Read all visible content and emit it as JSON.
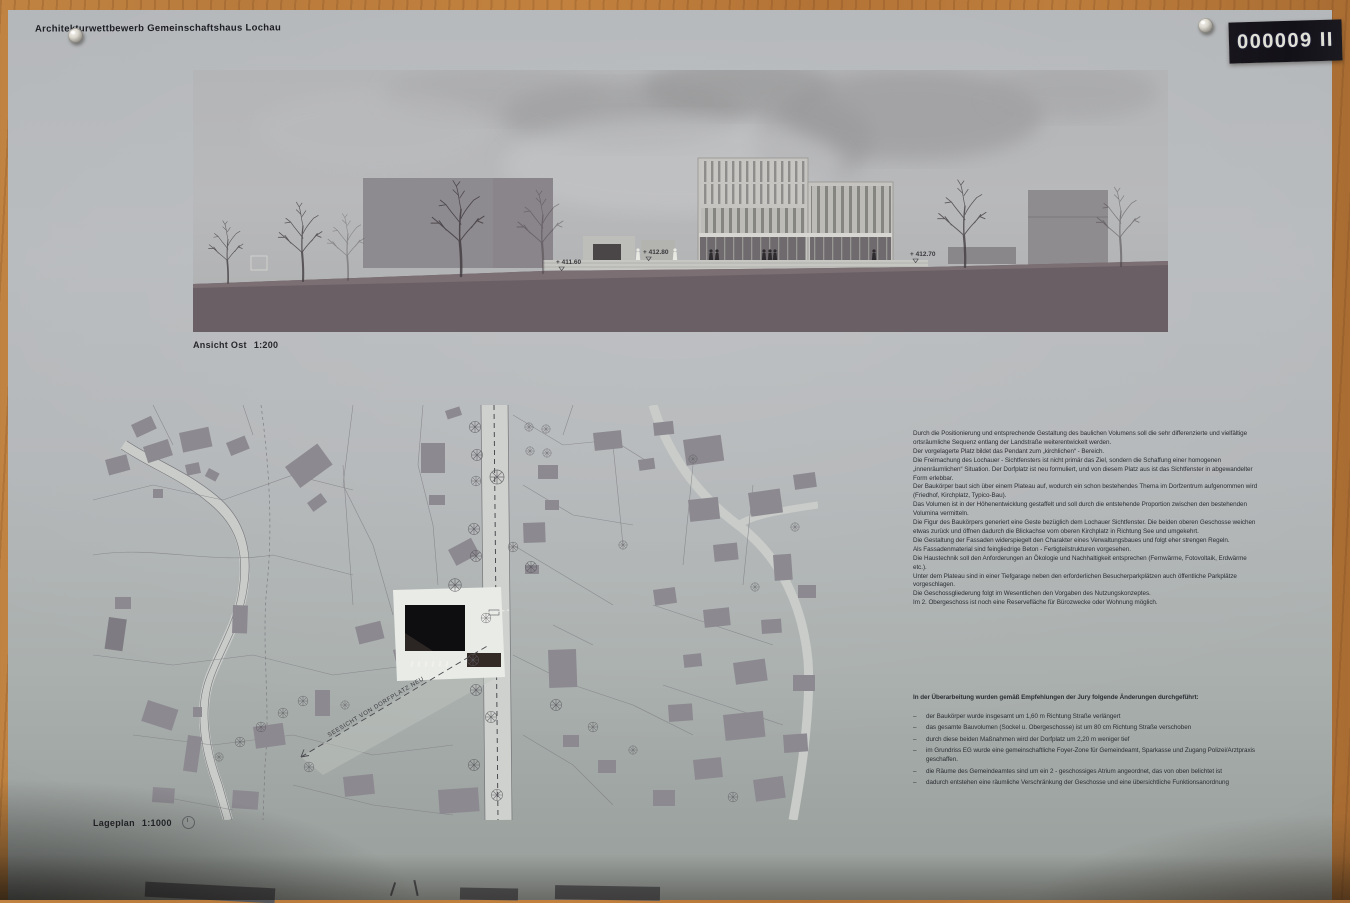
{
  "board": {
    "label": "000009 II"
  },
  "poster": {
    "title": "Architekturwettbewerb Gemeinschaftshaus Lochau",
    "elevation": {
      "caption": "Ansicht Ost",
      "scale": "1:200",
      "level_markers": [
        "+ 411.60",
        "+ 412.80",
        "+ 412.70"
      ]
    },
    "siteplan": {
      "caption": "Lageplan",
      "scale": "1:1000",
      "sightline_label": "SEESICHT VON DORFPLATZ NEU"
    },
    "description": {
      "paragraphs": [
        "Durch die Positionierung und entsprechende Gestaltung des baulichen Volumens soll die sehr differenzierte und vielfältige ortsräumliche Sequenz entlang der Landstraße weiterentwickelt werden.",
        "Der vorgelagerte Platz bildet das Pendant zum „kirchlichen“ - Bereich.",
        "Die Freimachung des Lochauer - Sichtfensters ist nicht primär das Ziel, sondern die Schaffung einer homogenen „innenräumlichen“ Situation. Der Dorfplatz ist neu formuliert, und von diesem Platz aus ist das Sichtfenster in abgewandelter Form erlebbar.",
        "Der Baukörper baut sich über einem Plateau auf, wodurch ein schon bestehendes Thema im Dorfzentrum aufgenommen wird (Friedhof, Kirchplatz, Typico-Bau).",
        "Das Volumen ist in der Höhenentwicklung gestaffelt und soll durch die entstehende Proportion zwischen den bestehenden Volumina vermitteln.",
        "Die Figur des Baukörpers generiert eine Geste bezüglich dem Lochauer Sichtfenster. Die beiden oberen Geschosse weichen etwas zurück und öffnen dadurch die Blickachse vom oberen Kirchplatz in Richtung See und umgekehrt.",
        "Die Gestaltung der Fassaden widerspiegelt den Charakter eines Verwaltungsbaues und folgt eher strengen Regeln.",
        "Als Fassadenmaterial sind feingliedrige Beton - Fertigteilstrukturen vorgesehen.",
        "Die Haustechnik soll den Anforderungen an Ökologie und Nachhaltigkeit entsprechen (Fernwärme, Fotovoltaik, Erdwärme etc.).",
        "Unter dem Plateau sind in einer Tiefgarage neben den erforderlichen Besucherparkplätzen auch öffentliche Parkplätze vorgeschlagen.",
        "Die Geschossgliederung folgt im Wesentlichen den Vorgaben des Nutzungskonzeptes.",
        "Im  2. Obergeschoss ist  noch eine Reservefläche für Bürozwecke oder Wohnung möglich."
      ]
    },
    "revisions": {
      "heading": "In der Überarbeitung wurden gemäß Empfehlungen der Jury folgende Änderungen durchgeführt:",
      "items": [
        "der Baukörper wurde insgesamt um 1,60 m Richtung Straße verlängert",
        "das gesamte Bauvolumen (Sockel u. Obergeschosse) ist um 80 cm Richtung Straße verschoben",
        "durch diese beiden Maßnahmen wird der Dorfplatz um 2,20 m weniger tief",
        "im Grundriss EG wurde eine gemeinschaftliche Foyer-Zone für Gemeindeamt, Sparkasse und Zugang Polizei/Arztpraxis geschaffen.",
        "die Räume des Gemeindeamtes sind um ein 2 - geschossiges Atrium angeordnet, das von oben belichtet ist",
        "dadurch entstehen eine räumliche Verschränkung der Geschosse und eine übersichtliche Funktionsanordnung"
      ]
    }
  },
  "colors": {
    "paper": "#b5b8ba",
    "wood": "#b97b3c",
    "ground_band": "#6a5f64",
    "map_building": "#8c8a90",
    "new_building": "#0e0d10",
    "label_bg": "#151419"
  }
}
